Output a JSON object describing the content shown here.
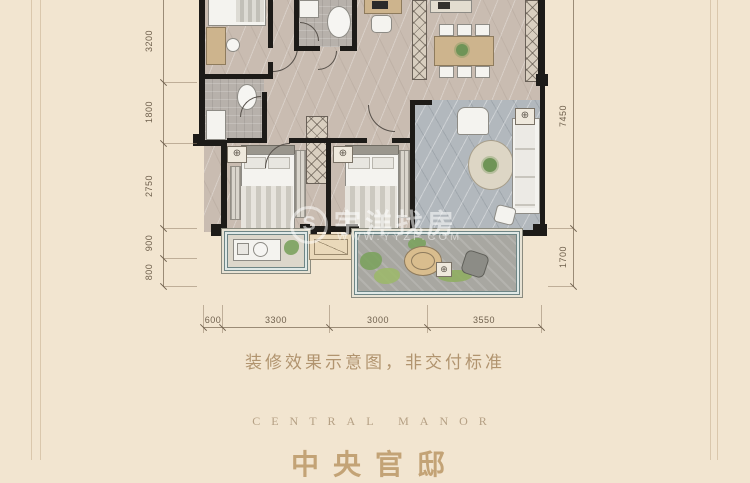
{
  "caption": "装修效果示意图，非交付标准",
  "brand": {
    "en": "CENTRAL MANOR",
    "cn_clipped": "中央官邸"
  },
  "watermark": {
    "logo_glyph": "S",
    "brand": "宇洋找房",
    "url": "WWW.YYZF.COM"
  },
  "dims": {
    "left": [
      "3200",
      "1800",
      "2750",
      "900",
      "800"
    ],
    "right": [
      "7450",
      "1700"
    ],
    "bottom": [
      "600",
      "3300",
      "3000",
      "3550"
    ]
  },
  "drain_glyph": "⊕",
  "colors": {
    "page_background": "#f2e5d0",
    "wall": "#1d1b18",
    "floor_marble": "#c9bcb1",
    "living_floor": "#b2b8bd",
    "balcony_stone": "#a8a7a1",
    "greenery": "#7ba25e",
    "caption_text": "#b1946f",
    "dimension_text": "#6f604d",
    "watermark": "rgba(255,255,255,0.55)"
  }
}
